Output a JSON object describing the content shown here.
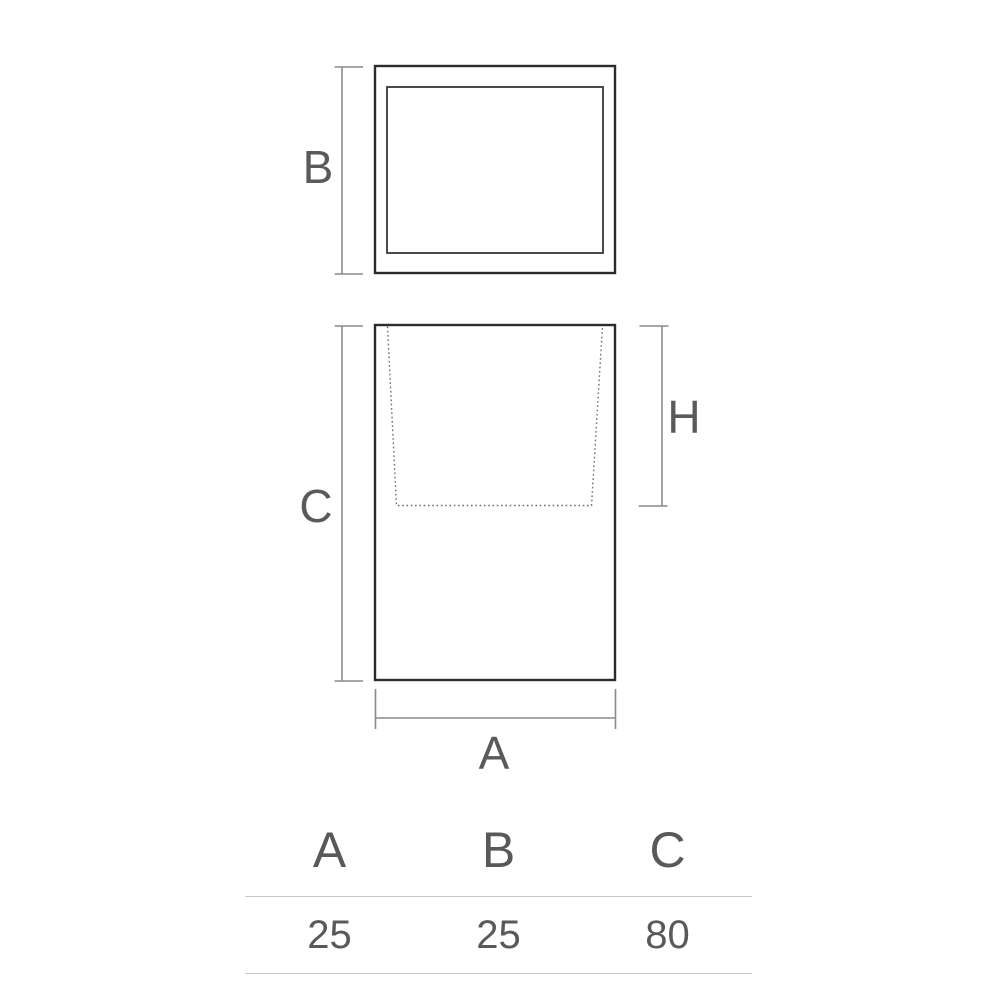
{
  "diagram": {
    "label_b": "B",
    "label_c": "C",
    "label_h": "H",
    "label_a": "A"
  },
  "table": {
    "headers": [
      "A",
      "B",
      "C"
    ],
    "rows": [
      [
        "25",
        "25",
        "80"
      ]
    ]
  },
  "colors": {
    "background": "#ffffff",
    "outline": "#2d2c2b",
    "dimension_line": "#8a8a8a",
    "dashed_line": "#6e6e6e",
    "label_text": "#5a5a5c",
    "table_text": "#595959",
    "table_rule": "#c8c8c8"
  }
}
